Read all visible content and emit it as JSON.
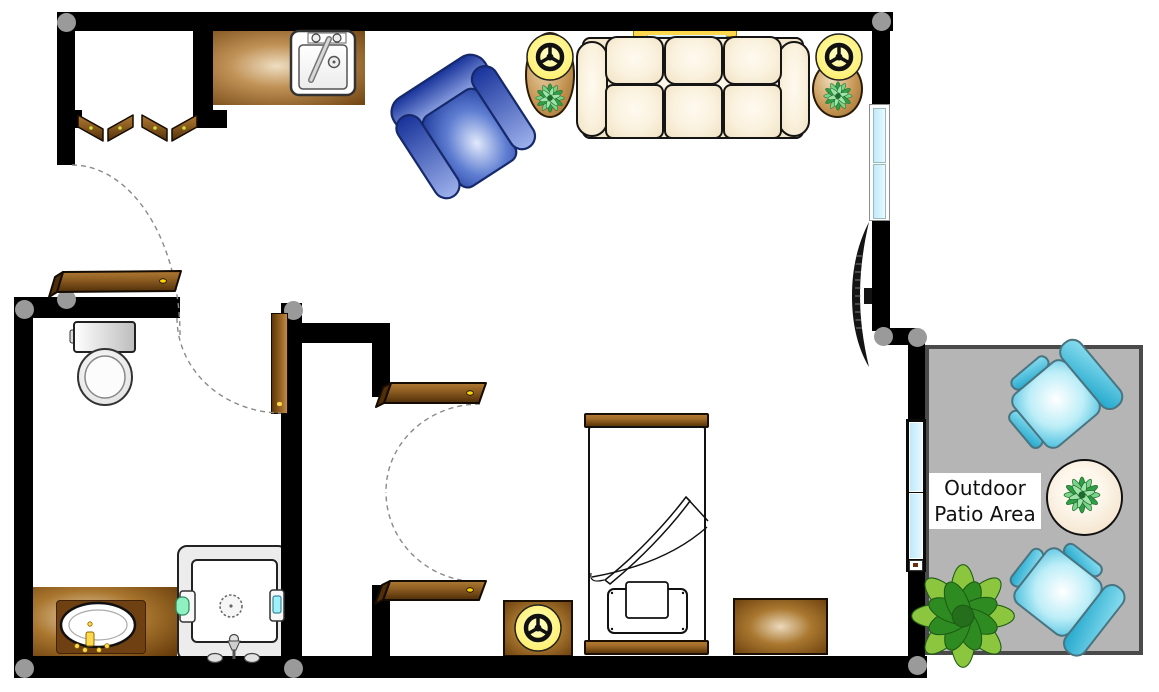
{
  "label": {
    "line1": "Outdoor",
    "line2": "Patio Area"
  },
  "colors": {
    "wall": "#000000",
    "post": "#9a9a9a",
    "floor": "#ffffff",
    "patio_floor": "#b5b5b5",
    "patio_border": "#4a4a4a",
    "wood_dark": "#5c3608",
    "wood_light": "#a06a28",
    "counter_edge": "#6f4310",
    "sofa_cream": "#faf1dd",
    "armchair_blue": "#2c4bb4",
    "patio_chair_cyan": "#35b6d9",
    "lamp_yellow": "#fff176",
    "plant_green": "#2f9e44",
    "bush_green": "#5cc43a",
    "glass_blue": "#bfe9fa",
    "accent_gold": "#ffd84d"
  },
  "furniture": [
    "kitchen-counter",
    "kitchen-sink",
    "entry-bifold-doors",
    "blue-armchair",
    "side-table-with-lamp-and-plant",
    "sofa",
    "wall-shelf-behind-sofa",
    "wall-mounted-tv",
    "toilet",
    "bathroom-vanity-sink",
    "shower-stall",
    "wardrobe-shelves",
    "bed",
    "nightstand-with-lamp",
    "dresser",
    "sliding-patio-door",
    "patio-chairs",
    "patio-round-table",
    "outdoor-bush"
  ]
}
